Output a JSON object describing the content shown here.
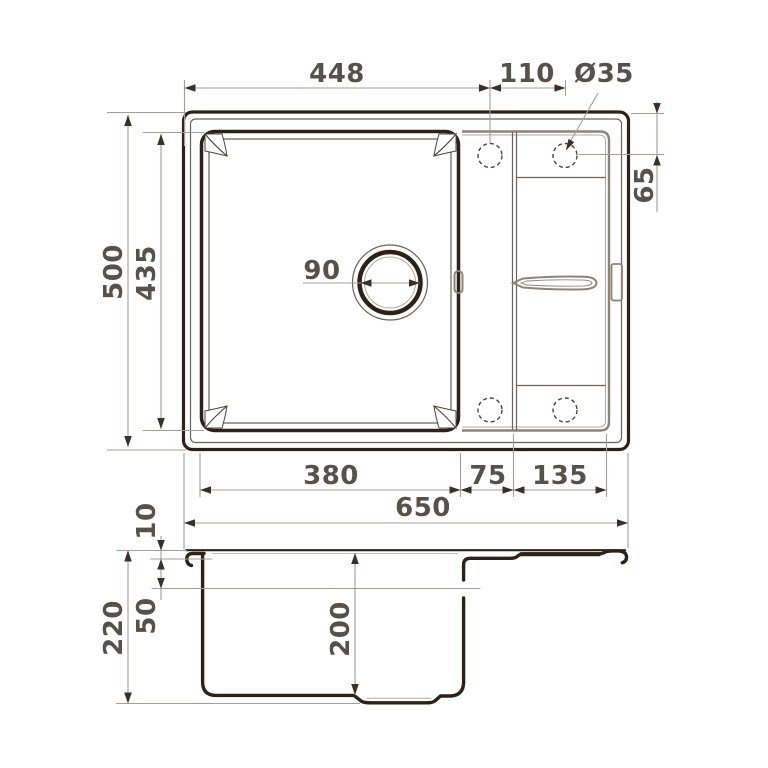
{
  "drawing": {
    "type": "sink-technical-drawing",
    "colors": {
      "outline": "#2e2218",
      "secondary": "#8d8379",
      "dim_line": "#a69d94",
      "dim_text": "#57514b",
      "background": "#ffffff"
    },
    "top_view": {
      "dims": {
        "left_to_tap_hole": "448",
        "tap_hole_spacing": "110",
        "tap_hole_diameter": "Ø35",
        "edge_to_tap_hole": "65",
        "overall_depth": "500",
        "bowl_depth": "435",
        "drain_diameter": "90",
        "bowl_width": "380",
        "bowl_to_drainer": "75",
        "drainer_width": "135",
        "overall_width": "650"
      }
    },
    "side_view": {
      "dims": {
        "rim_thickness": "10",
        "ledge_depth": "50",
        "overall_height": "220",
        "bowl_inner_depth": "200"
      }
    }
  }
}
